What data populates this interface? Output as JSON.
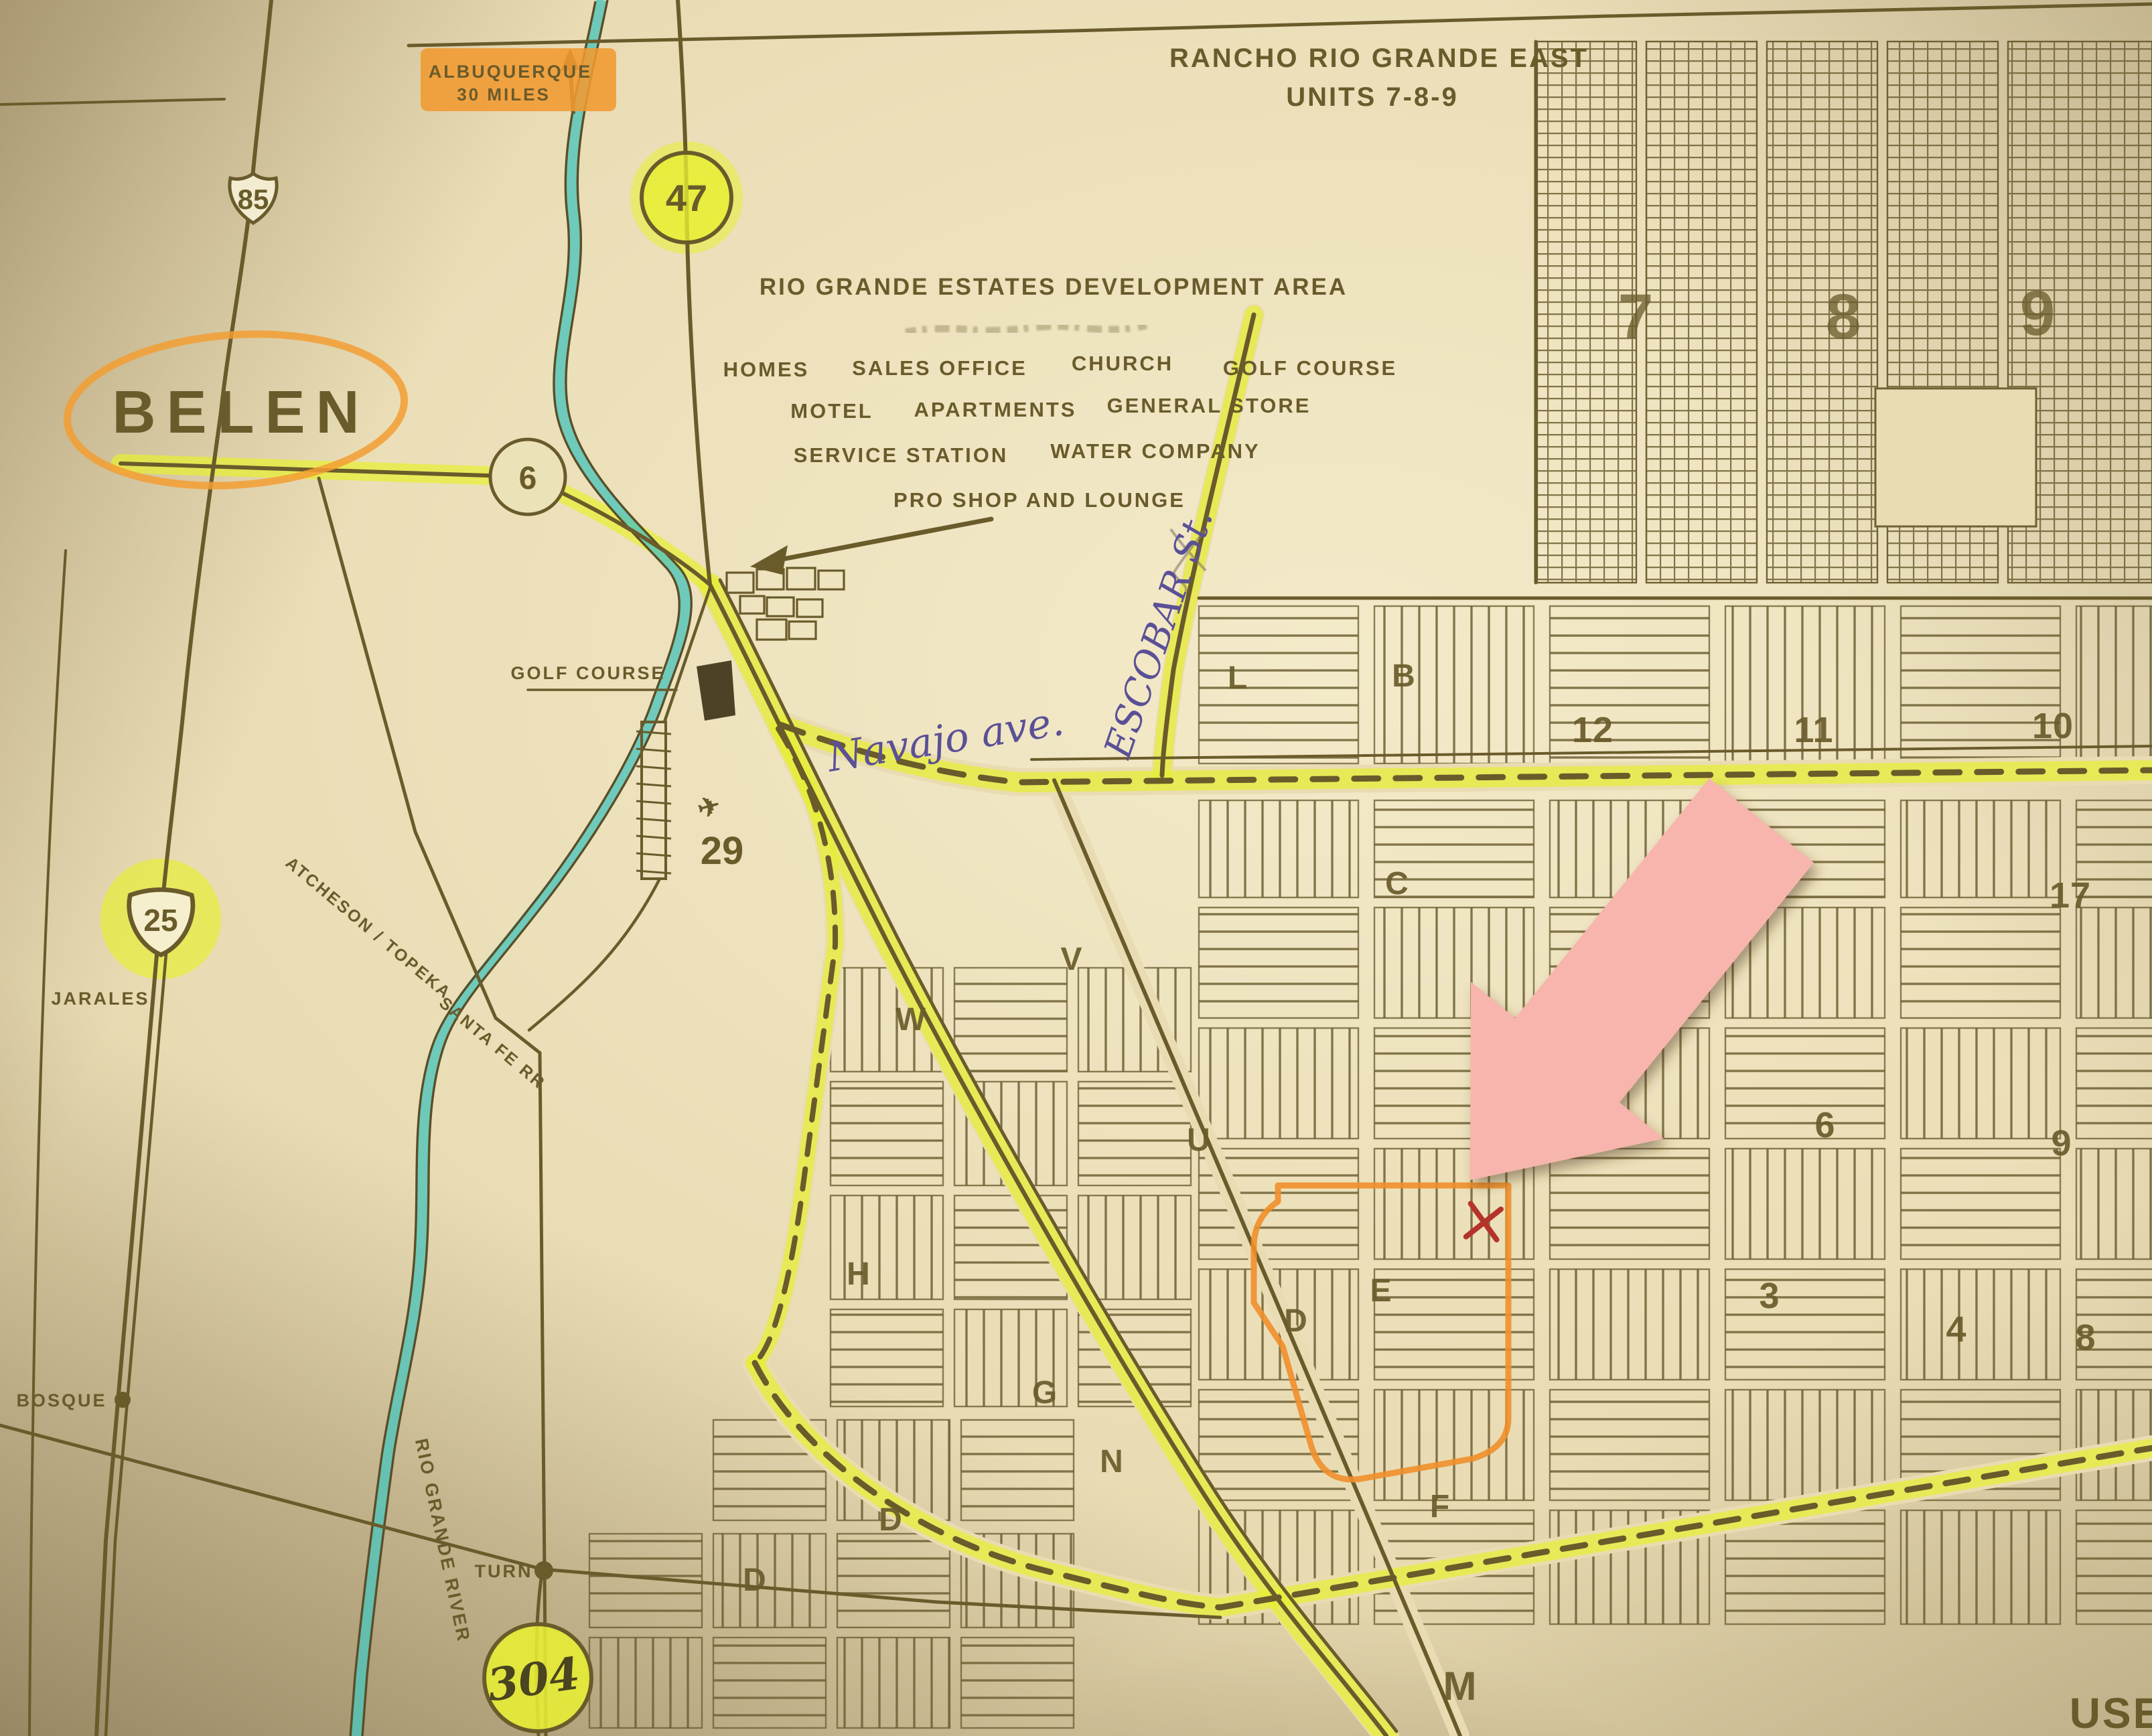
{
  "photo_type": "annotated paper map photograph",
  "top_note": {
    "line1": "ALBUQUERQUE",
    "line2": "30 MILES"
  },
  "title": {
    "line1": "RANCHO RIO GRANDE EAST",
    "line2": "UNITS 7-8-9"
  },
  "development": {
    "heading": "RIO GRANDE ESTATES DEVELOPMENT AREA",
    "amenities": [
      "HOMES",
      "SALES OFFICE",
      "CHURCH",
      "GOLF COURSE",
      "MOTEL",
      "APARTMENTS",
      "GENERAL STORE",
      "SERVICE STATION",
      "WATER COMPANY",
      "PRO SHOP AND LOUNGE"
    ]
  },
  "highways": {
    "us85": "85",
    "nm47": "47",
    "nm6": "6",
    "i25": "25",
    "nm304": "304",
    "marker29": "29"
  },
  "places": {
    "belen": "BELEN",
    "jarales": "JARALES",
    "bosque": "BOSQUE",
    "turn": "TURN"
  },
  "railroad": {
    "line1": "ATCHESON / TOPEKA",
    "line2": "SANTA FE RR"
  },
  "river_label": "RIO GRANDE RIVER",
  "handwriting": {
    "navajo": "Navajo ave.",
    "escobar": "ESCOBAR St."
  },
  "labels": {
    "golf_course": "GOLF COURSE",
    "edge_cut_text": "USE"
  },
  "units": {
    "dense": [
      "7",
      "8",
      "9"
    ],
    "row": [
      "12",
      "11",
      "10"
    ],
    "scattered": [
      "17",
      "6",
      "9",
      "3",
      "4",
      "8"
    ]
  },
  "blocks": {
    "letters": [
      "L",
      "B",
      "C",
      "W",
      "V",
      "U",
      "H",
      "N",
      "D",
      "E",
      "G",
      "D",
      "D",
      "F",
      "M"
    ]
  },
  "icons": {
    "airport": "✈"
  },
  "colors": {
    "paper": "#e9dcb2",
    "map_ink": "#6a5b2b",
    "highlighter_yellow": "#e7ee33",
    "highlighter_orange": "#f19a30",
    "river_teal": "#4fc4ba",
    "sticky_note_pink": "#f7b5ad",
    "handwriting_ink": "#5b5096",
    "x_mark_red": "#b5342a"
  }
}
